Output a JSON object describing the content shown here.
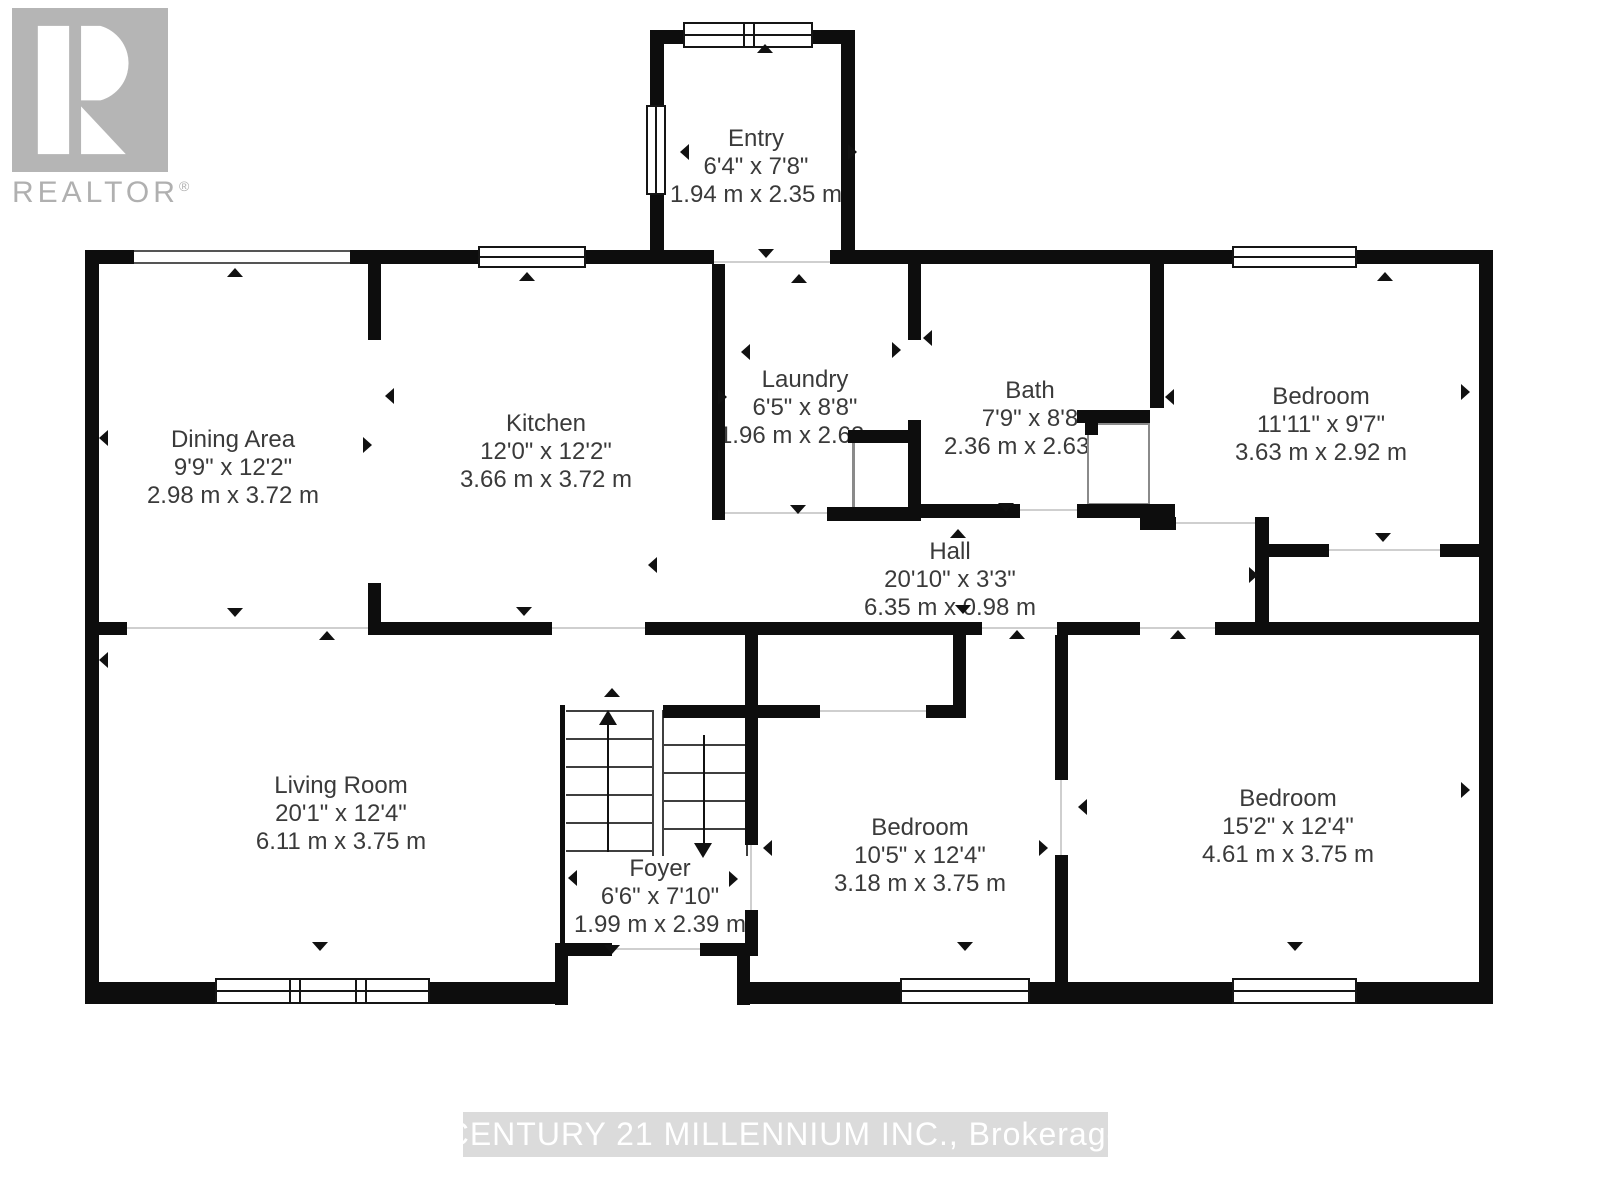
{
  "branding": {
    "logo_letter": "R",
    "logo_text": "REALTOR",
    "logo_registered": "®"
  },
  "watermark": {
    "text": "CENTURY 21 MILLENNIUM INC., Brokerage"
  },
  "rooms": {
    "entry": {
      "name": "Entry",
      "imperial": "6'4\" x 7'8\"",
      "metric": "1.94 m x 2.35 m"
    },
    "dining": {
      "name": "Dining Area",
      "imperial": "9'9\" x 12'2\"",
      "metric": "2.98 m x 3.72 m"
    },
    "kitchen": {
      "name": "Kitchen",
      "imperial": "12'0\" x 12'2\"",
      "metric": "3.66 m x 3.72 m"
    },
    "laundry": {
      "name": "Laundry",
      "imperial": "6'5\" x 8'8\"",
      "metric": "1.96 m x 2.63 m"
    },
    "bath": {
      "name": "Bath",
      "imperial": "7'9\" x 8'8",
      "metric": "2.36 m x 2.63 m"
    },
    "bedroom_tr": {
      "name": "Bedroom",
      "imperial": "11'11\" x 9'7\"",
      "metric": "3.63 m x 2.92 m"
    },
    "hall": {
      "name": "Hall",
      "imperial": "20'10\" x 3'3\"",
      "metric": "6.35 m x 0.98 m"
    },
    "living": {
      "name": "Living Room",
      "imperial": "20'1\" x 12'4\"",
      "metric": "6.11 m x 3.75 m"
    },
    "foyer": {
      "name": "Foyer",
      "imperial": "6'6\" x 7'10\"",
      "metric": "1.99 m x 2.39 m"
    },
    "bedroom_mid": {
      "name": "Bedroom",
      "imperial": "10'5\" x 12'4\"",
      "metric": "3.18 m x 3.75 m"
    },
    "bedroom_br": {
      "name": "Bedroom",
      "imperial": "15'2\" x 12'4\"",
      "metric": "4.61 m x 3.75 m"
    }
  },
  "colors": {
    "wall": "#0d0d0d",
    "label_text": "#3a3a3a",
    "logo_gray": "#b5b5b5",
    "watermark_bg": "#dbdbdb",
    "watermark_text": "#ffffff"
  }
}
